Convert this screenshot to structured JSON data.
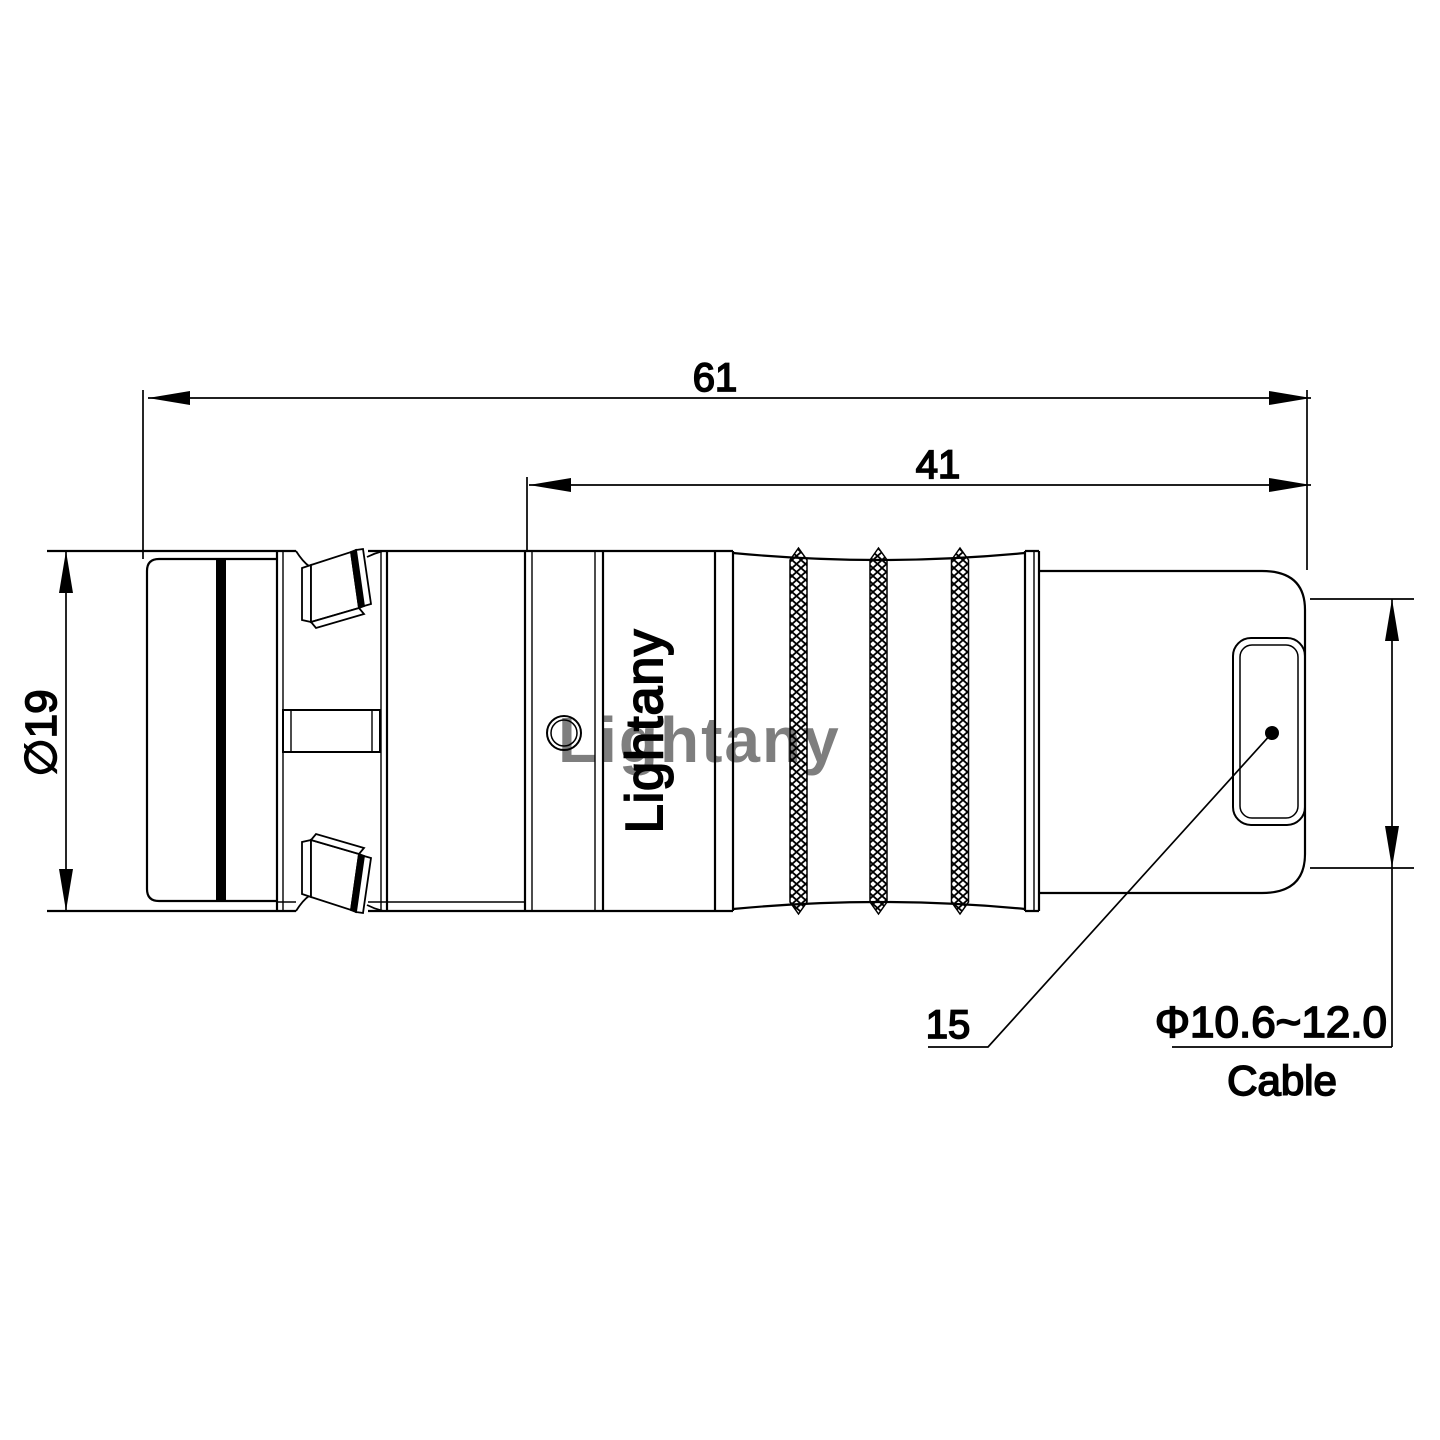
{
  "drawing": {
    "watermark": "Lightany",
    "engraving": "Lightany",
    "dims": {
      "overall_length": "61",
      "rear_length": "41",
      "diameter": "∅19",
      "callout": "15",
      "cable_range": "Φ10.6~12.0",
      "cable_word": "Cable"
    },
    "colors": {
      "line": "#000000",
      "background": "#ffffff",
      "watermark": "#efadad"
    }
  }
}
